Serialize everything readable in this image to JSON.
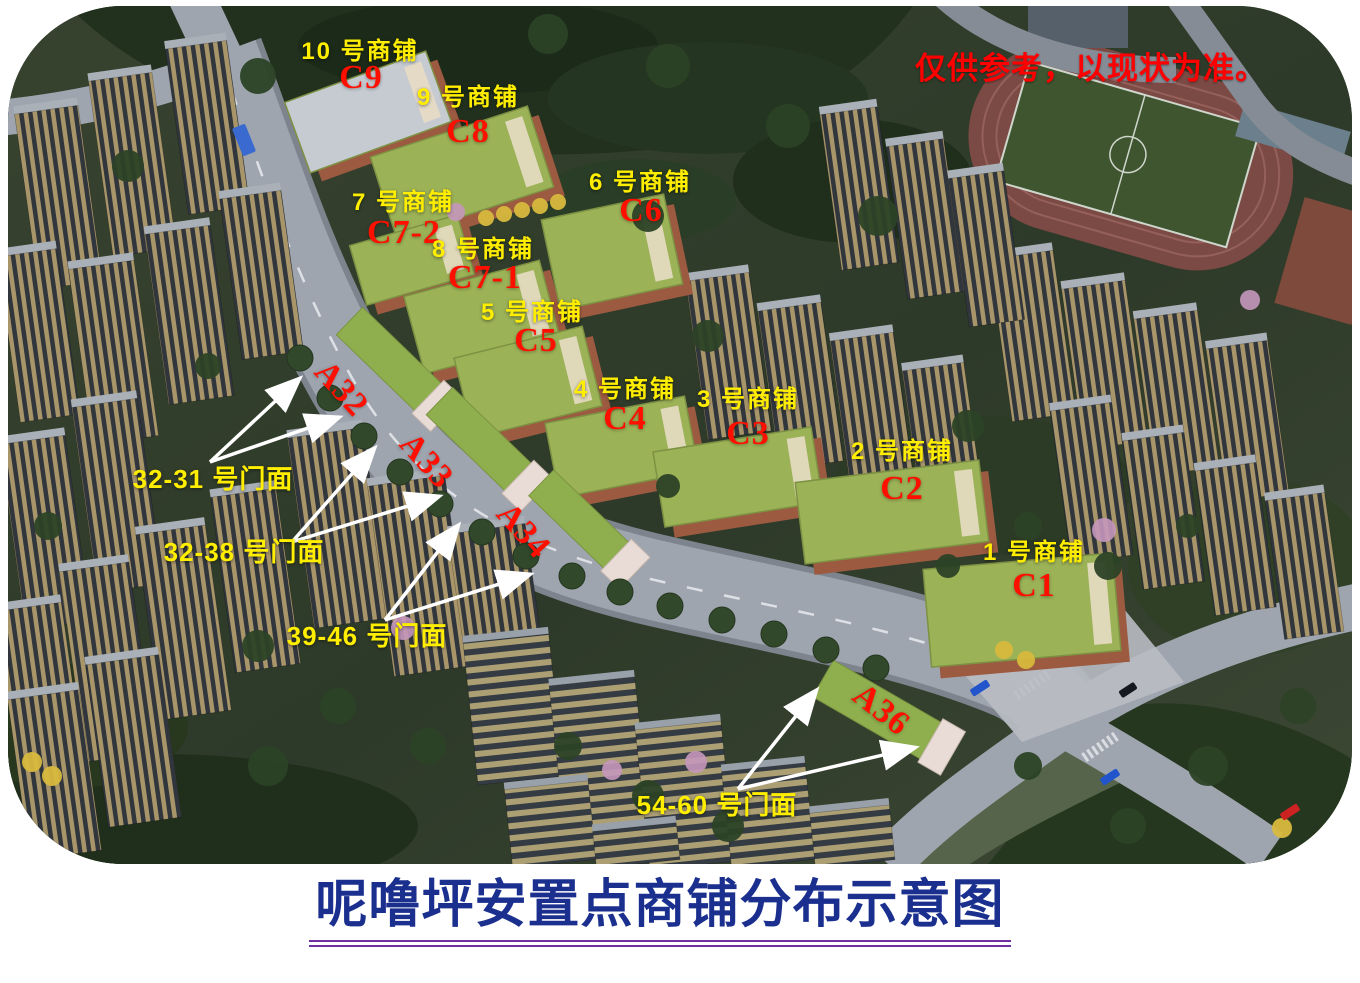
{
  "title": {
    "text": "呢噜坪安置点商铺分布示意图"
  },
  "disclaimer": {
    "text": "仅供参考，以现状为准。"
  },
  "shops": [
    {
      "name": "10 号商铺",
      "code": "C9"
    },
    {
      "name": "9 号商铺",
      "code": "C8"
    },
    {
      "name": "7 号商铺",
      "code": "C7-2"
    },
    {
      "name": "8 号商铺",
      "code": "C7-1"
    },
    {
      "name": "6 号商铺",
      "code": "C6"
    },
    {
      "name": "5 号商铺",
      "code": "C5"
    },
    {
      "name": "4 号商铺",
      "code": "C4"
    },
    {
      "name": "3 号商铺",
      "code": "C3"
    },
    {
      "name": "2 号商铺",
      "code": "C2"
    },
    {
      "name": "1 号商铺",
      "code": "C1"
    }
  ],
  "blocks": [
    {
      "code": "A32"
    },
    {
      "code": "A33"
    },
    {
      "code": "A34"
    },
    {
      "code": "A36"
    }
  ],
  "storefronts": [
    {
      "text": "32-31 号门面"
    },
    {
      "text": "32-38 号门面"
    },
    {
      "text": "39-46 号门面"
    },
    {
      "text": "54-60 号门面"
    }
  ],
  "colors": {
    "label_yellow": "#ffee00",
    "code_red": "#ff0f00",
    "title_blue": "#1b2f8f",
    "underline_purple": "#7030a0",
    "arrow_white": "#ffffff",
    "shop_roof_green": "#9cb257",
    "shop_wall_terracotta": "#9c5a41"
  }
}
